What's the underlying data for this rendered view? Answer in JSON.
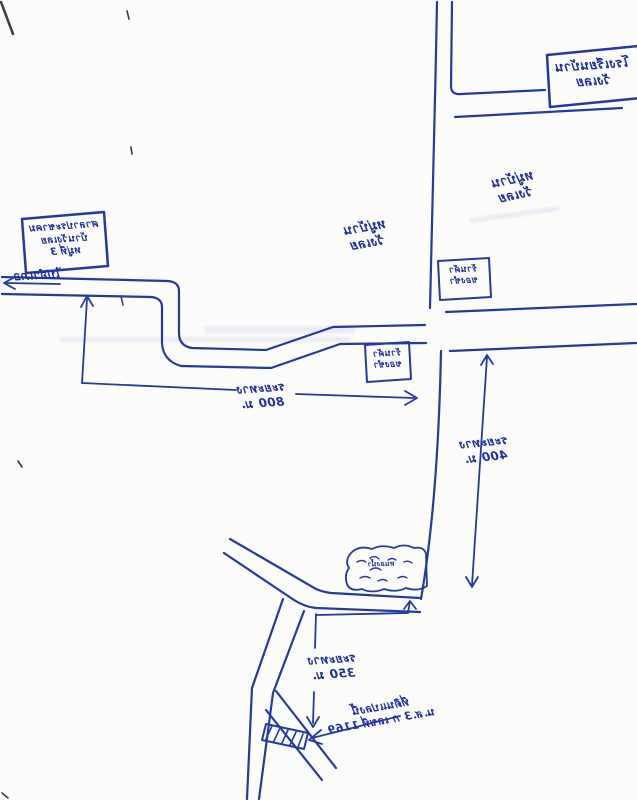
{
  "ink_color": "#2136a6",
  "labels": {
    "school_box": {
      "line1": "โรงเรียนบ้าน",
      "line2": "วังเลย"
    },
    "village_right": {
      "line1": "หมู่บ้าน",
      "line2": "วังเลย"
    },
    "village_center": {
      "line1": "หมู่บ้าน",
      "line2": "วังเลย"
    },
    "shop_box_upper": {
      "line1": "ร้านค้า",
      "line2": "ของชำ"
    },
    "shop_box_lower": {
      "line1": "ร้านค้า",
      "line2": "ของชำ"
    },
    "left_box": {
      "line1": "ศาลาประชาคม",
      "line2": "บ้านวังเลย",
      "line3": "หมู่ที่ 3"
    },
    "road_west": {
      "text": "ไปอำเภอ"
    },
    "distance_800": {
      "line1": "ระยะทาง",
      "line2": "800 ม."
    },
    "distance_400": {
      "line1": "ระยะทาง",
      "line2": "400 ม."
    },
    "distance_350": {
      "line1": "ระยะทาง",
      "line2": "350 ม."
    },
    "pond": {
      "text": "หนองน้ำ"
    },
    "parcel": {
      "line1": "ที่ดินแปลงนี้",
      "line2": "น.ส.3 ก เลขที่ 1169"
    }
  }
}
